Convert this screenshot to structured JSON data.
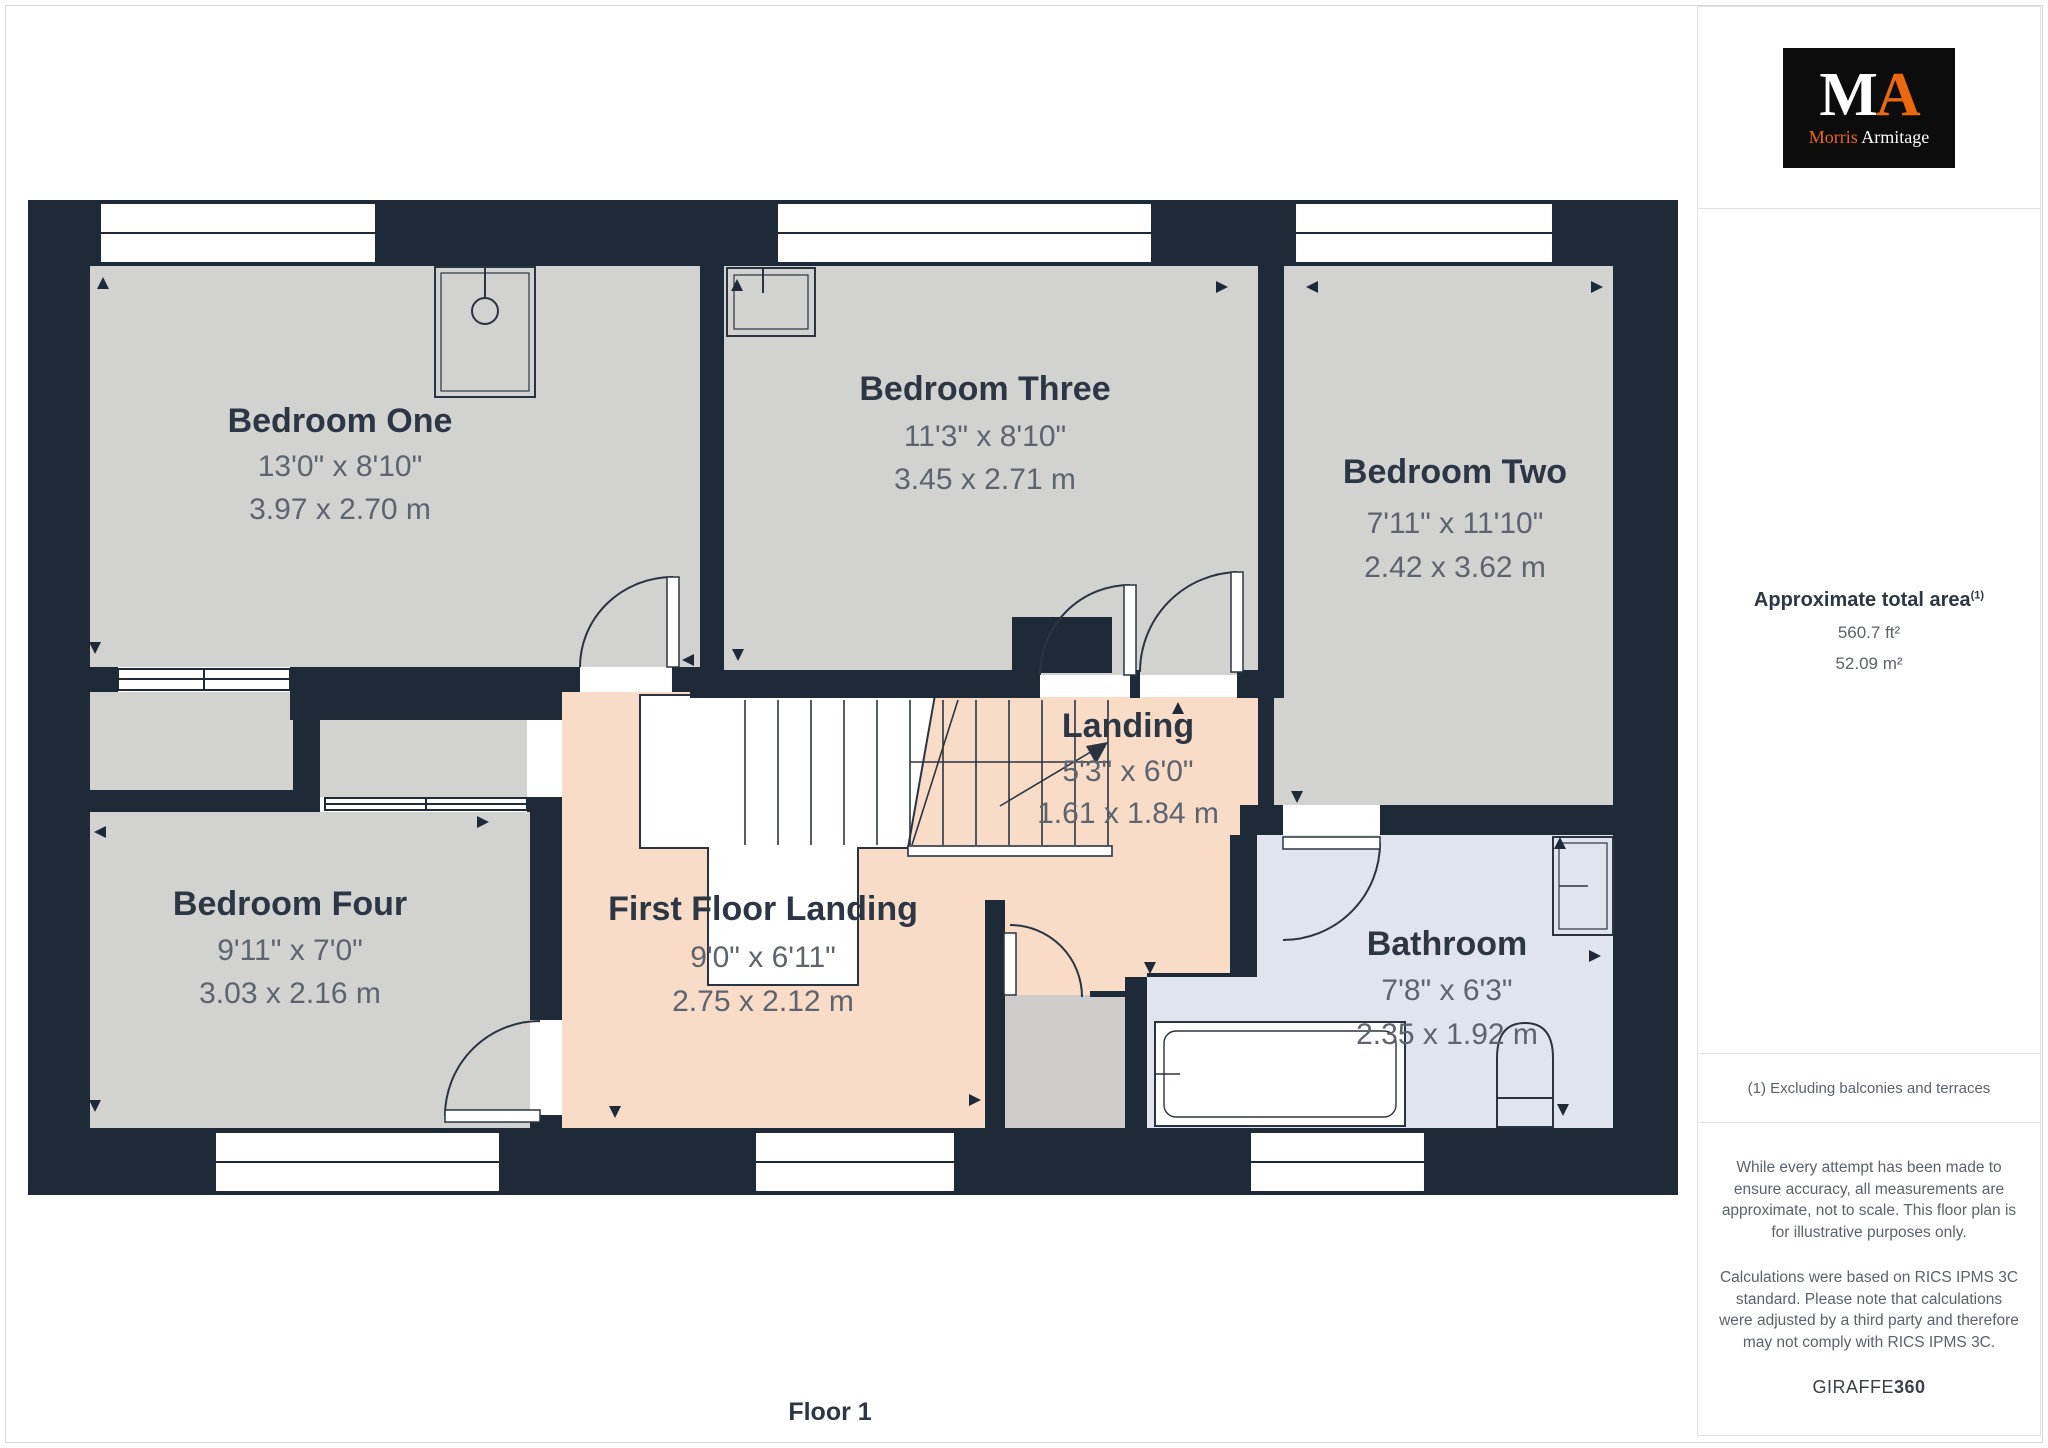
{
  "floor_label": "Floor 1",
  "logo": {
    "letter_m": "M",
    "letter_a": "A",
    "name_first": "Morris",
    "name_last": "Armitage"
  },
  "sidebar": {
    "area_heading": "Approximate total area",
    "area_superscript": "(1)",
    "area_ft": "560.7 ft²",
    "area_m": "52.09 m²",
    "footnote": "(1) Excluding balconies and terraces",
    "disclaimer1": "While every attempt has been made to ensure accuracy, all measurements are approximate, not to scale. This floor plan is for illustrative purposes only.",
    "disclaimer2": "Calculations were based on RICS IPMS 3C standard. Please note that calculations were adjusted by a third party and therefore may not comply with RICS IPMS 3C.",
    "brand": "GIRAFFE",
    "brand_bold": "360"
  },
  "colors": {
    "wall": "#1e2a38",
    "room_gray": "#d2d2d1",
    "landing_peach": "#f8dcc7",
    "bathroom_blue": "#e0e4ef",
    "accent_orange": "#ea690f",
    "label_navy": "#2d3643",
    "dim_gray": "#5d646e"
  },
  "rooms": [
    {
      "name": "Bedroom One",
      "imperial": "13'0\" x 8'10\"",
      "metric": "3.97 x 2.70 m"
    },
    {
      "name": "Bedroom Three",
      "imperial": "11'3\" x 8'10\"",
      "metric": "3.45 x 2.71 m"
    },
    {
      "name": "Bedroom Two",
      "imperial": "7'11\" x 11'10\"",
      "metric": "2.42 x 3.62 m"
    },
    {
      "name": "Bedroom Four",
      "imperial": "9'11\" x 7'0\"",
      "metric": "3.03 x 2.16 m"
    },
    {
      "name": "Landing",
      "imperial": "5'3\" x 6'0\"",
      "metric": "1.61 x 1.84 m"
    },
    {
      "name": "First Floor Landing",
      "imperial": "9'0\" x 6'11\"",
      "metric": "2.75 x 2.12 m"
    },
    {
      "name": "Bathroom",
      "imperial": "7'8\" x 6'3\"",
      "metric": "2.35 x 1.92 m"
    }
  ]
}
